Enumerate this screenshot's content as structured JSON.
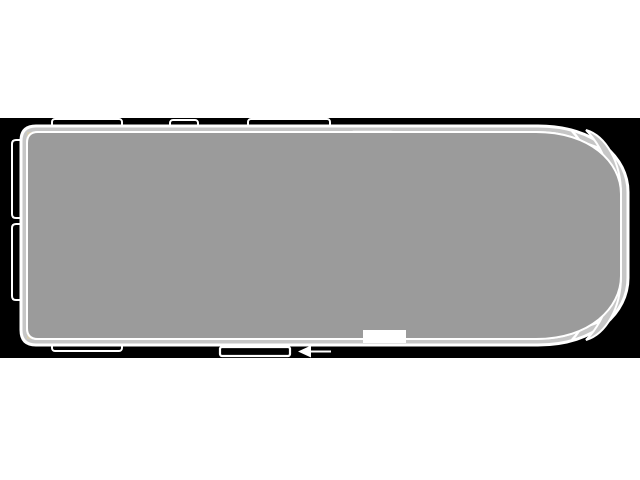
{
  "diagram": {
    "type": "campervan-floorplan-top-view",
    "background": "#ffffff",
    "colors": {
      "band": "#000000",
      "shell": "#c6c6c6",
      "floor": "#9b9b9b",
      "wall_line": "#ffffff",
      "bed_area": "#d4cbb1",
      "bed_dash": "#8a8a8a",
      "bathroom": "#c3d6e2",
      "counter": "#bdd0de",
      "basin": "#b5cbdb",
      "toilet": "#a6bfd2",
      "partition_wall": "#8f8f8f",
      "lift_strip": "#e9e3d2",
      "bench": "#e0b6ac",
      "table": "#dcb3ab",
      "seat": "#e4debf",
      "windshield": "#e3e3e3",
      "headlight": "#dedede",
      "kitchen": "#cdd5c9",
      "appliance": "#a7aaa4",
      "red": "#c62828"
    },
    "icons": [
      "seat-rotate-arrow-icon",
      "table-rotate-arrow-icon",
      "lift-up-arrow-icon",
      "lift-down-arrow-icon",
      "door-direction-arrow-icon",
      "faucet-icon",
      "sink-cross-icon",
      "hob-burner-icon"
    ]
  }
}
